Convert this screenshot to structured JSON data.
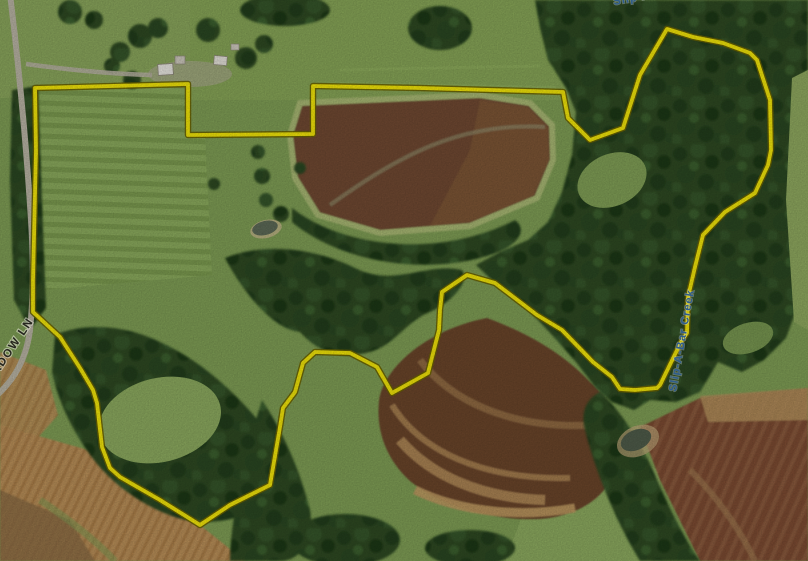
{
  "map": {
    "description": "aerial-parcel-map",
    "road_label": "MEADOW LN",
    "creek_label_side": "Slip-A-Bar Creek",
    "creek_label_top": "Slip-A-Bar Creek",
    "boundary_color": "#f2e50a",
    "boundary_edge_color": "#6b6400"
  }
}
